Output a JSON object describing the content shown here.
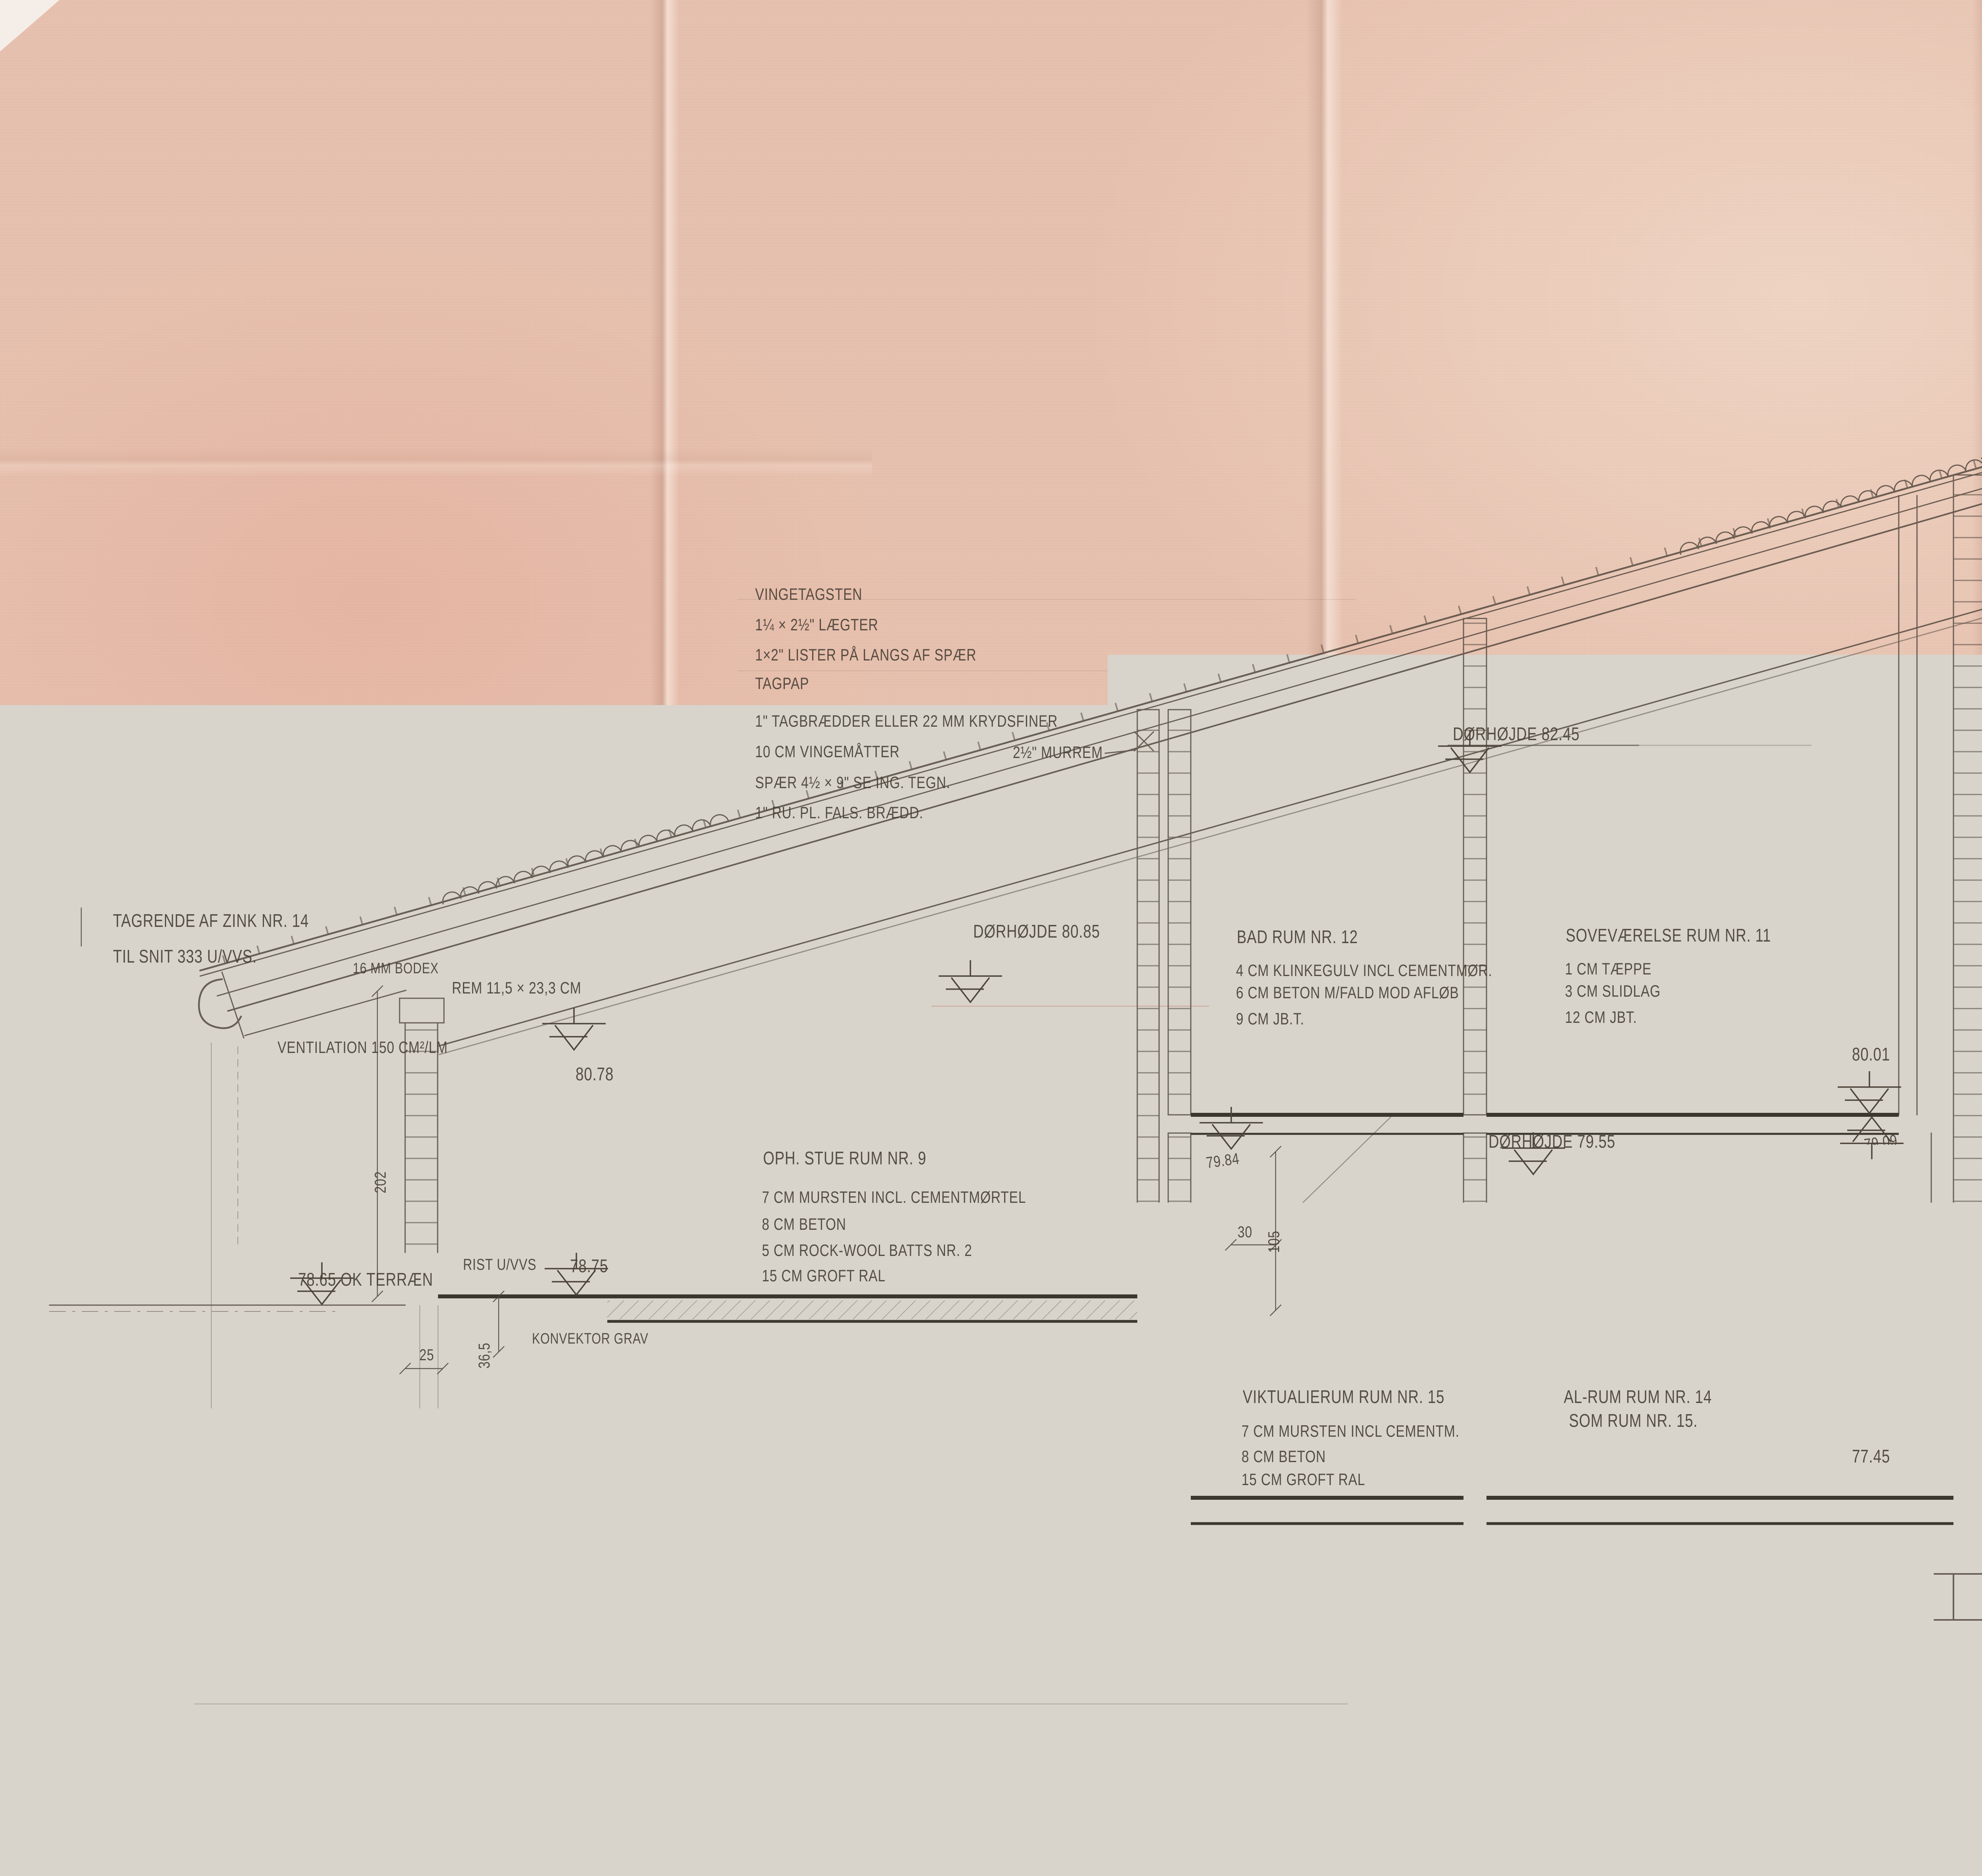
{
  "colors": {
    "paper": "#e7c1af",
    "pencil": "#554a40",
    "heavy": "#3b372e",
    "stamp_red": "#c1362c",
    "ink_blue": "#32417c"
  },
  "drawing": {
    "eave": {
      "tagrende1": "TAGRENDE AF ZINK NR. 14",
      "tagrende2": "TIL SNIT 333 U/VVS.",
      "ventilation": "VENTILATION 150 CM²/LM",
      "bodex": "16 MM BODEX",
      "rem": "REM 11,5 × 23,3 CM"
    },
    "roof_spec": {
      "l1": "VINGETAGSTEN",
      "l2": "1¼ × 2½\" LÆGTER",
      "l3": "1×2\" LISTER PÅ LANGS AF SPÆR",
      "l4": "TAGPAP",
      "l5": "1\" TAGBRÆDDER ELLER 22 MM KRYDSFINER",
      "l6": "10 CM VINGEMÅTTER",
      "l7": "SPÆR 4½ × 9\" SE ING. TEGN.",
      "l8": "1\" RU. PL. FALS. BRÆDD."
    },
    "notes": {
      "murrem_half": "2½\" MURREM",
      "rist": "RIST U/VVS",
      "konvektor": "KONVEKTOR GRAV",
      "pap": "PAP",
      "rockwool": "ROCK-WOOL",
      "flamingo": "3 CM FLAMINGO"
    },
    "doors": {
      "d1": "DØRHØJDE 82.45",
      "d2": "DØRHØJDE 80.85",
      "d3": "DØRHØJDE 79.55"
    },
    "right": {
      "tagsten": "TAGSTEN LAGT I BASTARDMØRTEL NR 1.",
      "kopskifte": "KOPSKIFTE MED STUDSFUG UDKRADSET TIL VENTILATION   AREAL/LM  102 CM²",
      "murrem24": "2×4\" MURREM"
    },
    "levels": {
      "v8400": "84.00",
      "v8358": "83.58",
      "v8226": "82.26",
      "v8135": "81.35",
      "v8134": "81.34",
      "v8043": "80.43",
      "v8001r": "80.01",
      "v8001f": "80.01",
      "v8078": "80.78",
      "v7984": "79.84",
      "v7909": "79.09",
      "v7875": "78.75",
      "v7865": "78.65 OK TERRÆN",
      "v7745": "77.45",
      "okterr": "OK TERRÆN"
    },
    "rooms": {
      "stue": {
        "title": "OPH. STUE RUM NR. 9",
        "l1": "7 CM MURSTEN INCL. CEMENTMØRTEL",
        "l2": "8 CM BETON",
        "l3": "5 CM ROCK-WOOL BATTS NR. 2",
        "l4": "15 CM GROFT RAL"
      },
      "bad": {
        "title": "BAD RUM NR. 12",
        "l1": "4 CM KLINKEGULV INCL CEMENTMØR.",
        "l2": "6 CM BETON M/FALD MOD AFLØB",
        "l3": "9 CM JB.T."
      },
      "sove": {
        "title": "SOVEVÆRELSE RUM NR. 11",
        "l1": "1 CM TÆPPE",
        "l2": "3 CM SLIDLAG",
        "l3": "12 CM JBT."
      },
      "vikt": {
        "title": "VIKTUALIERUM RUM NR. 15",
        "l1": "7 CM MURSTEN INCL CEMENTM.",
        "l2": "8 CM BETON",
        "l3": "15 CM GROFT RAL"
      },
      "alrum1": "AL-RUM RUM NR. 14",
      "alrum2": "SOM RUM NR. 15."
    },
    "dims": {
      "d138": "138",
      "d12": "12",
      "d150": "150",
      "d450": "450",
      "d100": "100",
      "d14": "14",
      "d30a": "30",
      "d510": "510",
      "d30b": "30",
      "d202": "202",
      "d105": "105",
      "d30c": "30",
      "d365": "36,5",
      "d25": "25",
      "d92": "92",
      "d133": "133",
      "d57": "57",
      "d42a": "42",
      "d42b": "42",
      "d103": "103"
    },
    "caption": {
      "scale": "SNIT 1:20",
      "text": "GENNEM RUM NR. 9 - 11 - 12 - 14 - OG 15"
    }
  },
  "title_block": {
    "line1": "VILLA FOR DIREKTØR POUL ALSTRUP SKÅDE",
    "line2": "SNIT I RUM 9-11-12-14 OG 15",
    "line3": "K. FRIIS OG E. MOLTKE NIELSEN , ARKITEKTER M.A.A.",
    "line4": "VESTERBROGADE 32 , ÅRHUS C  -  TLF. 12 27 00",
    "dato_label": "DATO:",
    "dato": "13.9.71",
    "rev_label": "REV.:",
    "maal_label": "MÅL:",
    "maal": "1 : 20",
    "sag_label": "SAG:",
    "sag": "71/20",
    "nr_label": "NR:",
    "nr": "202"
  },
  "stamp": {
    "line1": "BYGN. INSP.",
    "line2": "17.9.71 * 71 - 6714",
    "line3": "BILAG Nr.",
    "handwritten": "1e"
  }
}
